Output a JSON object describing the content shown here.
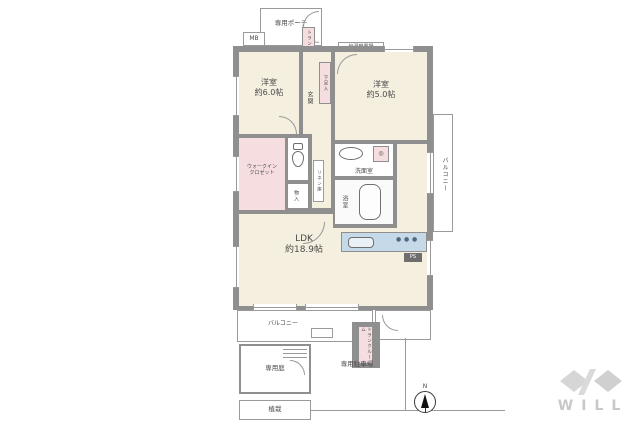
{
  "rooms": {
    "west6": {
      "name": "洋室",
      "size": "約6.0帖"
    },
    "west5": {
      "name": "洋室",
      "size": "約5.0帖"
    },
    "ldk": {
      "name": "LDK",
      "size": "約18.9帖"
    },
    "wic": {
      "line1": "ウォークイン",
      "line2": "クロゼット"
    },
    "genkan": "玄関",
    "geta": "下足入",
    "monoire": "物入",
    "linen": "リネン庫",
    "washroom": "洗面室",
    "bath": "浴室",
    "balcony_right": "バルコニー",
    "balcony_bottom": "バルコニー",
    "porch": "専用ポーチ",
    "mb": "MB",
    "trunk_top": "トランクルーム",
    "trunk_bottom": "トランクルーム",
    "heater": "給湯機置場",
    "ps": "PS",
    "garden": "専用庭",
    "parking": "専用駐車場",
    "planting": "植栽"
  },
  "compass": {
    "label": "N"
  },
  "logo": {
    "text": "WILL"
  },
  "icons": {
    "washer": "◎",
    "stove_burner": "●"
  },
  "colors": {
    "wall": "#8f8f8f",
    "room_floor": "#f5efdf",
    "closet_pink": "#f5dde0",
    "kitchen_panel": "#c6d9e8",
    "logo_gray": "#c8c8c8"
  }
}
